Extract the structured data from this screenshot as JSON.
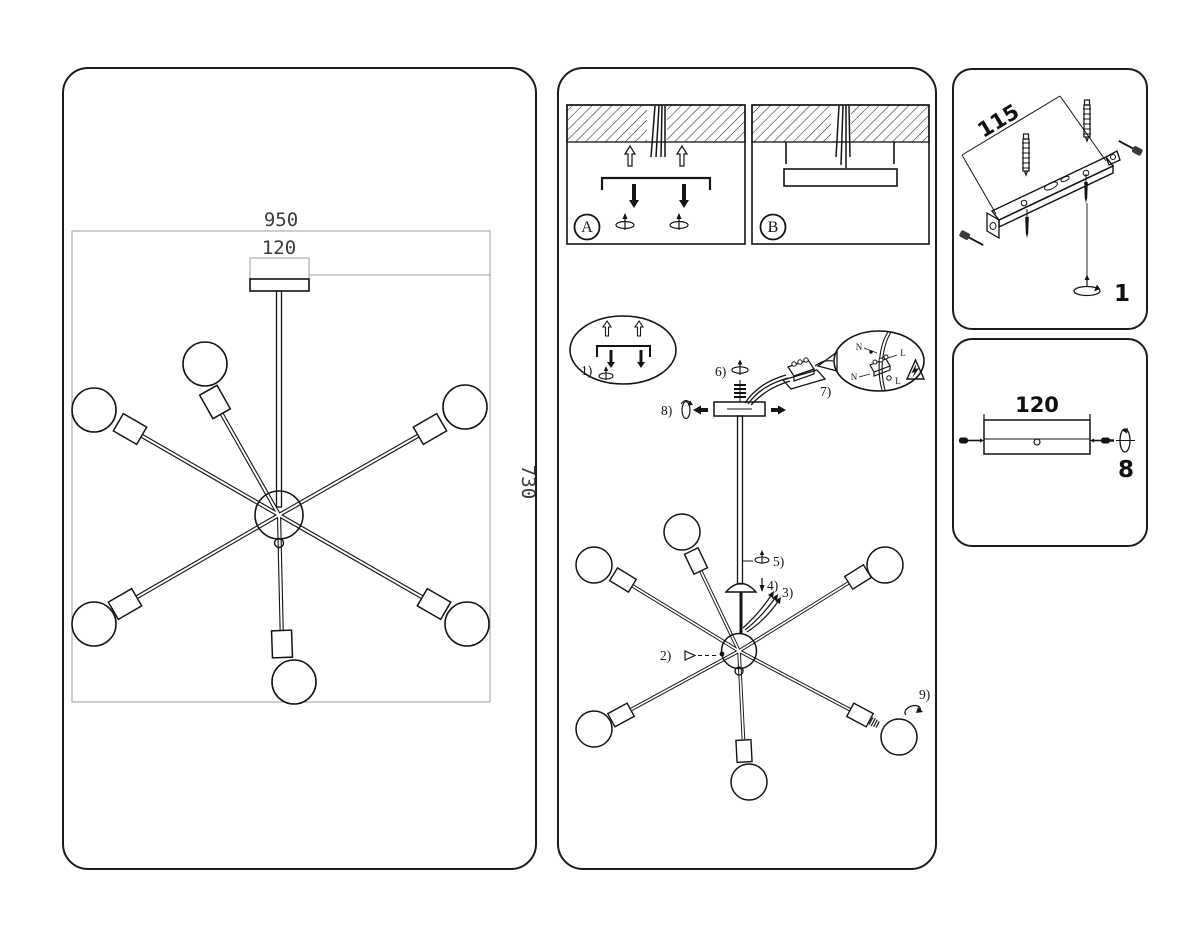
{
  "colors": {
    "ink": "#141414",
    "dim_line": "#9f9f9f",
    "dim_text": "#3c3c3c"
  },
  "dims": {
    "overall_width": "950",
    "canopy_width": "120",
    "overall_height": "730"
  },
  "install": {
    "option_a": "A",
    "option_b": "B",
    "step1": "1)",
    "step2": "2)",
    "step3": "3)",
    "step4": "4)",
    "step5": "5)",
    "step6": "6)",
    "step7": "7)",
    "step8": "8)",
    "step9": "9)",
    "wire_n_top": "N",
    "wire_l_top": "L",
    "wire_n_bottom": "N",
    "wire_l_bottom": "L"
  },
  "bracket": {
    "length": "115",
    "step": "1"
  },
  "canopy": {
    "width": "120",
    "step": "8"
  }
}
